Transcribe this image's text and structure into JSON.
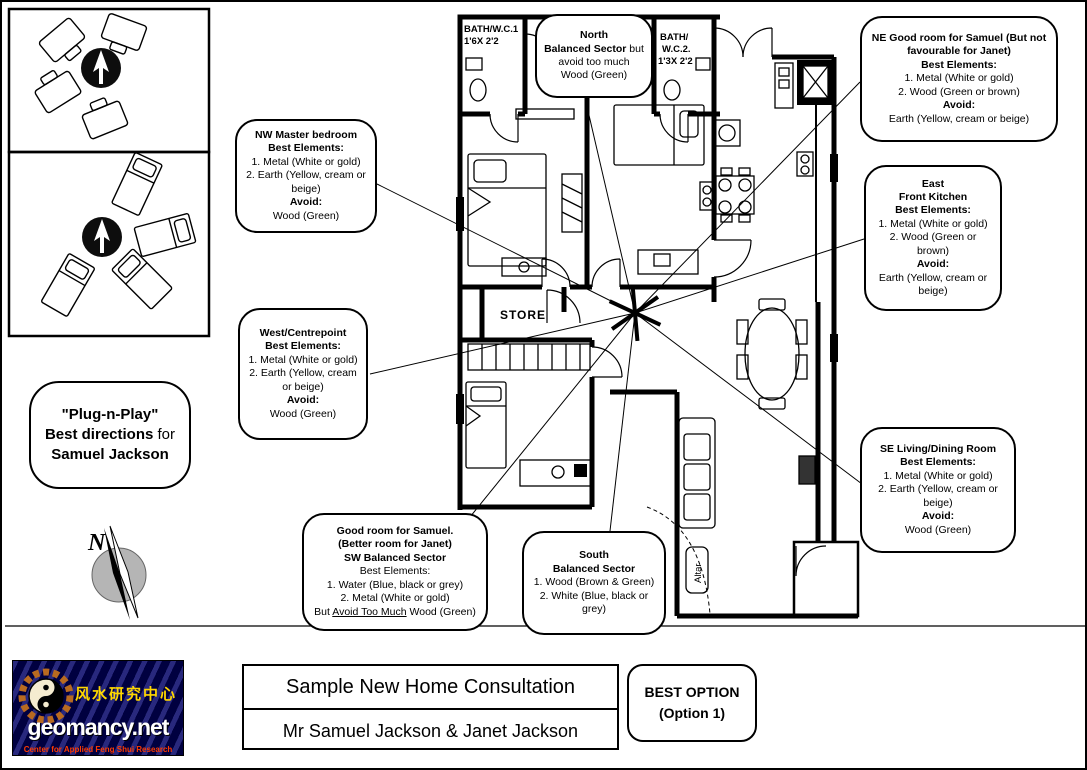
{
  "titles": {
    "consultation": "Sample New Home Consultation",
    "clients": "Mr Samuel Jackson & Janet Jackson",
    "best_option_line1": "BEST OPTION",
    "best_option_line2": "(Option 1)"
  },
  "logo": {
    "chinese": "风水研究中心",
    "brand": "geomancy.net",
    "tagline": "Center for Applied Feng Shui Research",
    "colors": {
      "background_navy": "#000040",
      "chinese_yellow": "#ffd700",
      "tagline_red": "#ff3a00"
    }
  },
  "plug_bubble": [
    [
      {
        "t": "\"Plug-n-Play\"",
        "b": 1
      }
    ],
    [
      {
        "t": "Best directions",
        "b": 1
      },
      {
        "t": " for",
        "b": 0
      }
    ],
    [
      {
        "t": "Samuel Jackson",
        "b": 1
      }
    ]
  ],
  "compass_rose": {
    "north_label": "N"
  },
  "plan": {
    "store": "STORE",
    "altar": "Altar",
    "bath1_line1": "BATH/W.C.1",
    "bath1_line2": "1'6X 2'2",
    "bath2_line1": "BATH/",
    "bath2_line2": "W.C.2.",
    "bath2_line3": "1'3X 2'2"
  },
  "callouts": {
    "north": [
      [
        {
          "t": "North",
          "b": 1
        }
      ],
      [
        {
          "t": "Balanced Sector",
          "b": 1
        },
        {
          "t": " but",
          "b": 0
        }
      ],
      [
        {
          "t": "avoid too much Wood (Green)",
          "b": 0
        }
      ]
    ],
    "ne": [
      [
        {
          "t": "NE Good room for Samuel (But not favourable for Janet)",
          "b": 1
        }
      ],
      [
        {
          "t": "Best Elements:",
          "b": 1
        }
      ],
      [
        {
          "t": "1. Metal (White or gold)",
          "b": 0
        }
      ],
      [
        {
          "t": "2. Wood (Green or brown)",
          "b": 0
        }
      ],
      [
        {
          "t": "Avoid:",
          "b": 1
        }
      ],
      [
        {
          "t": "Earth (Yellow, cream or beige)",
          "b": 0
        }
      ]
    ],
    "nw": [
      [
        {
          "t": "NW Master bedroom",
          "b": 1
        }
      ],
      [
        {
          "t": "Best Elements:",
          "b": 1
        }
      ],
      [
        {
          "t": "1. Metal (White or gold)",
          "b": 0
        }
      ],
      [
        {
          "t": "2. Earth (Yellow, cream or beige)",
          "b": 0
        }
      ],
      [
        {
          "t": "Avoid:",
          "b": 1
        }
      ],
      [
        {
          "t": "Wood (Green)",
          "b": 0
        }
      ]
    ],
    "east": [
      [
        {
          "t": "East",
          "b": 1
        }
      ],
      [
        {
          "t": "Front Kitchen",
          "b": 1
        }
      ],
      [
        {
          "t": "Best Elements:",
          "b": 1
        }
      ],
      [
        {
          "t": "1. Metal (White or gold)",
          "b": 0
        }
      ],
      [
        {
          "t": "2. Wood (Green or brown)",
          "b": 0
        }
      ],
      [
        {
          "t": "Avoid:",
          "b": 1
        }
      ],
      [
        {
          "t": "Earth (Yellow, cream or beige)",
          "b": 0
        }
      ]
    ],
    "west": [
      [
        {
          "t": "West/Centrepoint",
          "b": 1
        }
      ],
      [
        {
          "t": "Best Elements:",
          "b": 1
        }
      ],
      [
        {
          "t": "1. Metal (White or gold)",
          "b": 0
        }
      ],
      [
        {
          "t": "2. Earth (Yellow, cream or beige)",
          "b": 0
        }
      ],
      [
        {
          "t": "Avoid:",
          "b": 1
        }
      ],
      [
        {
          "t": "Wood (Green)",
          "b": 0
        }
      ]
    ],
    "se": [
      [
        {
          "t": "SE Living/Dining Room",
          "b": 1
        }
      ],
      [
        {
          "t": "Best Elements:",
          "b": 1
        }
      ],
      [
        {
          "t": "1. Metal (White or gold)",
          "b": 0
        }
      ],
      [
        {
          "t": "2. Earth (Yellow, cream or beige)",
          "b": 0
        }
      ],
      [
        {
          "t": "Avoid:",
          "b": 1
        }
      ],
      [
        {
          "t": "Wood (Green)",
          "b": 0
        }
      ]
    ],
    "sw": [
      [
        {
          "t": "Good room for Samuel.",
          "b": 1
        }
      ],
      [
        {
          "t": "(Better room for Janet)",
          "b": 1
        }
      ],
      [
        {
          "t": "SW Balanced Sector",
          "b": 1
        }
      ],
      [
        {
          "t": "Best Elements:",
          "b": 0
        }
      ],
      [
        {
          "t": "1. Water (Blue, black or grey)",
          "b": 0
        }
      ],
      [
        {
          "t": "2. Metal (White or gold)",
          "b": 0
        }
      ],
      [
        {
          "t": "But ",
          "b": 0
        },
        {
          "t": "Avoid Too Much",
          "b": 0,
          "u": 1
        },
        {
          "t": " Wood (Green)",
          "b": 0
        }
      ]
    ],
    "south": [
      [
        {
          "t": "South",
          "b": 1
        }
      ],
      [
        {
          "t": "Balanced Sector",
          "b": 1
        }
      ],
      [
        {
          "t": "1. Wood (Brown & Green)",
          "b": 0
        }
      ],
      [
        {
          "t": "2. White (Blue, black or grey)",
          "b": 0
        }
      ]
    ]
  }
}
